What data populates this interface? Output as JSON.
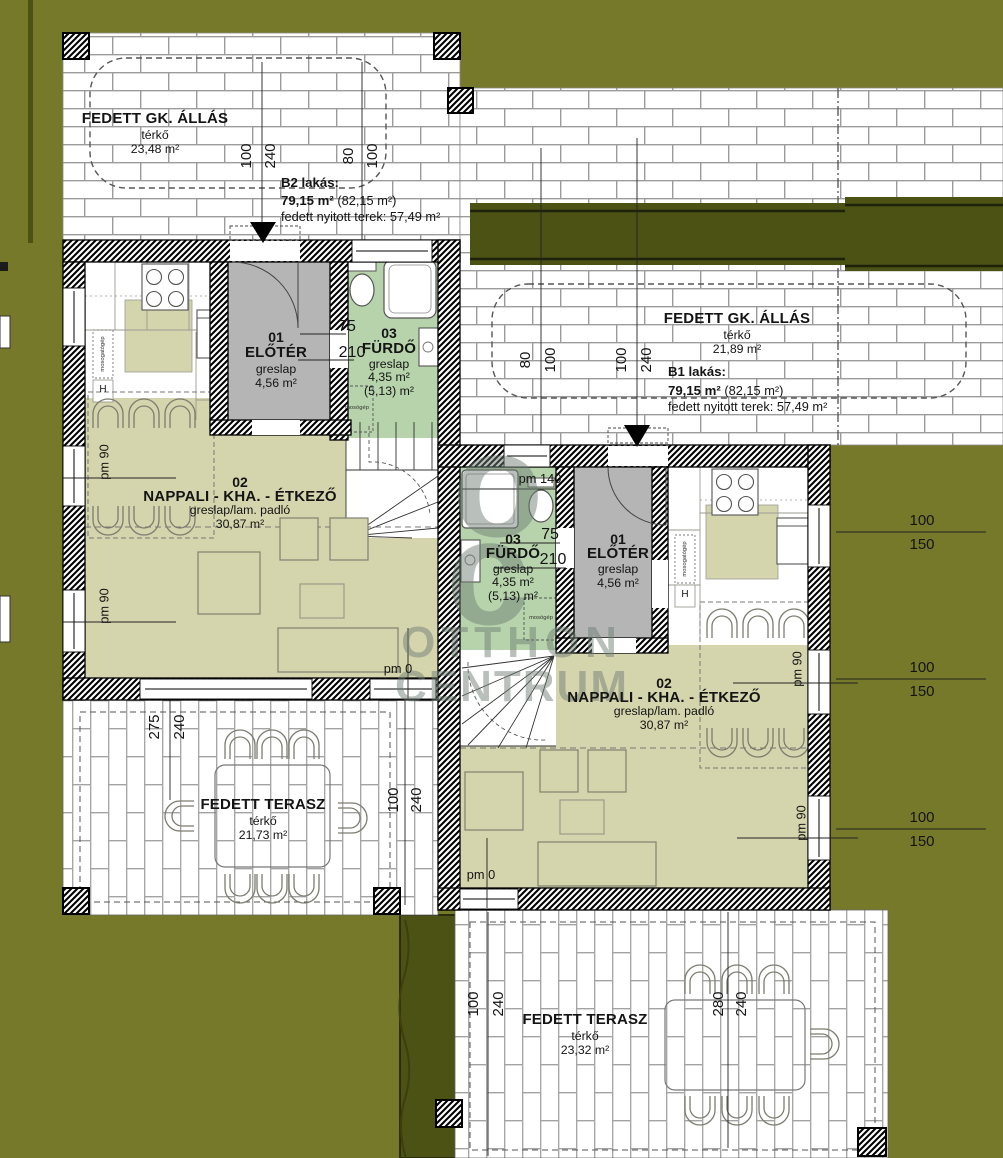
{
  "carports": {
    "left": {
      "title": "FEDETT GK. ÁLLÁS",
      "surface": "térkő",
      "area": "23,48 m²"
    },
    "right": {
      "title": "FEDETT GK. ÁLLÁS",
      "surface": "térkő",
      "area": "21,89 m²"
    }
  },
  "apartments": {
    "b2": {
      "name": "B2 lakás:",
      "area": "79,15 m²",
      "gross": " (82,15 m²)",
      "covered": "fedett nyitott terek: 57,49 m²"
    },
    "b1": {
      "name": "B1 lakás:",
      "area": "79,15 m²",
      "gross": " (82,15 m²)",
      "covered": "fedett nyitott terek: 57,49 m²"
    }
  },
  "rooms": {
    "b2_eloter": {
      "num": "01",
      "name": "ELŐTÉR",
      "floor": "greslap",
      "area": "4,56 m²"
    },
    "b2_furdo": {
      "num": "03",
      "name": "FÜRDŐ",
      "floor": "greslap",
      "area": "4,35 m²",
      "area_alt": "(5,13) m²"
    },
    "b2_nappali": {
      "num": "02",
      "name": "NAPPALI - KHA. - ÉTKEZŐ",
      "floor": "greslap/lam. padló",
      "area": "30,87 m²"
    },
    "b1_furdo": {
      "num": "03",
      "name": "FÜRDŐ",
      "floor": "greslap",
      "area": "4,35 m²",
      "area_alt": "(5,13) m²"
    },
    "b1_eloter": {
      "num": "01",
      "name": "ELŐTÉR",
      "floor": "greslap",
      "area": "4,56 m²"
    },
    "b1_nappali": {
      "num": "02",
      "name": "NAPPALI - KHA. - ÉTKEZŐ",
      "floor": "greslap/lam. padló",
      "area": "30,87 m²"
    }
  },
  "terraces": {
    "b2": {
      "title": "FEDETT TERASZ",
      "surface": "térkő",
      "area": "21,73 m²"
    },
    "b1": {
      "title": "FEDETT TERASZ",
      "surface": "térkő",
      "area": "23,32 m²"
    }
  },
  "dims": {
    "d100": "100",
    "d240": "240",
    "d80": "80",
    "d75": "75",
    "d210": "210",
    "d150": "150",
    "d275": "275",
    "d280": "280",
    "pm0": "pm 0",
    "pm90": "pm 90",
    "pm140": "pm 140"
  },
  "appliances": {
    "dishwasher": "mosogatógép",
    "washer": "mosógép",
    "hood": "H"
  },
  "watermark": {
    "o": "o",
    "c": "c",
    "line1": "OTTHON",
    "line2": "CENTRUM"
  },
  "colors": {
    "yard": "#76792a",
    "hedge": "#4b5214",
    "living": "#d5d5ad",
    "bath": "#b7d3ab",
    "hall": "#b5b5b5",
    "watermark": "#6e7d73"
  }
}
